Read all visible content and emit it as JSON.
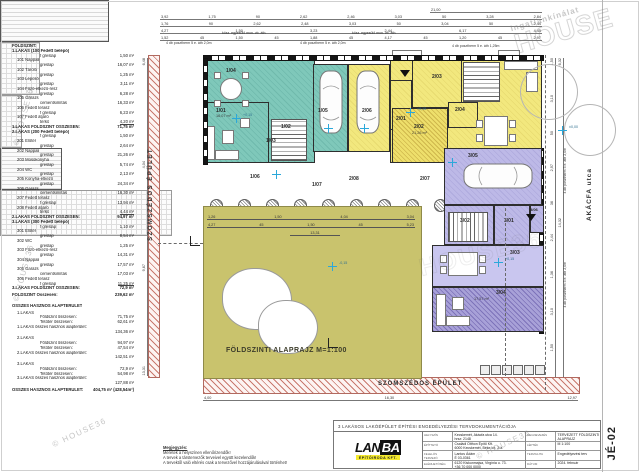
{
  "watermark": {
    "copyright": "© HOUSE36",
    "brand_top": "Ingatlankínálat",
    "brand_big": "HOUSE",
    "brand_big2": "HOUSE36"
  },
  "schedule": {
    "lines": [
      {
        "t": "FÖLDSZINT:",
        "c": "h"
      },
      {
        "t": "1.LAKÁS (100 Fedett belépő)",
        "c": "h"
      },
      {
        "t": "f greslap",
        "v": "1,50 m²",
        "c": "i2"
      },
      {
        "t": "101 Nappali",
        "c": "i1"
      },
      {
        "t": "greslap",
        "v": "16,07 m²",
        "c": "i2"
      },
      {
        "t": "102 Tároló",
        "c": "i1"
      },
      {
        "t": "greslap",
        "v": "1,25 m²",
        "c": "i2"
      },
      {
        "t": "103 Lépcső",
        "c": "i1"
      },
      {
        "t": "greslap",
        "v": "3,11 m²",
        "c": "i2"
      },
      {
        "t": "104 Főző-étkező-rész",
        "c": "i1"
      },
      {
        "t": "greslap",
        "v": "6,28 m²",
        "c": "i2"
      },
      {
        "t": "105 Garázs",
        "c": "i1"
      },
      {
        "t": "cementsimítás",
        "v": "16,33 m²",
        "c": "i2"
      },
      {
        "t": "106 Fedett terasz",
        "c": "i1"
      },
      {
        "t": "f greslap",
        "v": "6,23 m²",
        "c": "i2"
      },
      {
        "t": "107 Fedett átjáró",
        "c": "i1"
      },
      {
        "t": "térkő",
        "v": "4,20 m²",
        "c": "i2 u"
      },
      {
        "t": "1.LAKÁS FÖLDSZINT ÖSSZESEN:",
        "v": "71,75 m²",
        "c": "h"
      },
      {
        "t": "2.LAKÁS (200 Fedett belépő)",
        "c": "h"
      },
      {
        "t": "f greslap",
        "v": "1,50 m²",
        "c": "i2"
      },
      {
        "t": "201 Előtér",
        "c": "i1"
      },
      {
        "t": "greslap",
        "v": "2,64 m²",
        "c": "i2"
      },
      {
        "t": "202 Nappali",
        "c": "i1"
      },
      {
        "t": "greslap",
        "v": "21,26 m²",
        "c": "i2"
      },
      {
        "t": "203 Mosókonyha",
        "c": "i1"
      },
      {
        "t": "greslap",
        "v": "5,74 m²",
        "c": "i2"
      },
      {
        "t": "204 WC",
        "c": "i1"
      },
      {
        "t": "greslap",
        "v": "2,13 m²",
        "c": "i2"
      },
      {
        "t": "205 Konyha-étkező",
        "c": "i1"
      },
      {
        "t": "greslap",
        "v": "24,34 m²",
        "c": "i2"
      },
      {
        "t": "206 Garázs",
        "c": "i1"
      },
      {
        "t": "cementsimítás",
        "v": "16,30 m²",
        "c": "i2"
      },
      {
        "t": "207 Fedett terasz",
        "c": "i1"
      },
      {
        "t": "f greslap",
        "v": "13,94 m²",
        "c": "i2"
      },
      {
        "t": "208 Fedett átjáró",
        "c": "i1"
      },
      {
        "t": "térkő",
        "v": "4,44 m²",
        "c": "i2 u"
      },
      {
        "t": "2.LAKÁS FÖLDSZINT ÖSSZESEN:",
        "v": "94,97 m²",
        "c": "h"
      },
      {
        "t": "3.LAKÁS (300 Fedett belépő)",
        "c": "h"
      },
      {
        "t": "f greslap",
        "v": "1,10 m²",
        "c": "i2"
      },
      {
        "t": "301 Előtér",
        "c": "i1"
      },
      {
        "t": "greslap",
        "v": "8,54 m²",
        "c": "i2"
      },
      {
        "t": "302 WC",
        "c": "i1"
      },
      {
        "t": "greslap",
        "v": "1,25 m²",
        "c": "i2"
      },
      {
        "t": "303 Főző-étkező-rész",
        "c": "i1"
      },
      {
        "t": "greslap",
        "v": "14,31 m²",
        "c": "i2"
      },
      {
        "t": "304 Nappali",
        "c": "i1"
      },
      {
        "t": "greslap",
        "v": "17,57 m²",
        "c": "i2"
      },
      {
        "t": "305 Garázs",
        "c": "i1"
      },
      {
        "t": "cementsimítás",
        "v": "17,03 m²",
        "c": "i2"
      },
      {
        "t": "306 Fedett terasz",
        "c": "i1"
      },
      {
        "t": "f greslap",
        "v": "11,25 m²",
        "c": "i2 u"
      },
      {
        "t": "3.LAKÁS FÖLDSZINT ÖSSZESEN:",
        "v": "72,9 m²",
        "c": "h"
      },
      {
        "t": "FÖLDSZINT Összesen:",
        "v": "239,62 m²",
        "c": "h gap"
      },
      {
        "t": "",
        "c": "sp"
      },
      {
        "t": "ÖSSZES HASZNOS ALAPTERÜLET",
        "c": "h"
      },
      {
        "t": "1.LAKÁS",
        "c": "i1 gap"
      },
      {
        "t": "Földszint összesen:",
        "v": "71,75 m²",
        "c": "i2"
      },
      {
        "t": "Tetőtér összesen:",
        "v": "62,61 m²",
        "c": "i2"
      },
      {
        "t": "1.LAKÁS összes hasznos alapterület:",
        "c": "i1"
      },
      {
        "t": "",
        "v": "134,36 m²",
        "c": "i2"
      },
      {
        "t": "2.LAKÁS",
        "c": "i1 gap"
      },
      {
        "t": "Földszint összesen:",
        "v": "94,97 m²",
        "c": "i2"
      },
      {
        "t": "Tetőtér összesen:",
        "v": "47,54 m²",
        "c": "i2"
      },
      {
        "t": "2.LAKÁS összes hasznos alapterület:",
        "c": "i1"
      },
      {
        "t": "",
        "v": "142,51 m²",
        "c": "i2"
      },
      {
        "t": "3.LAKÁS",
        "c": "i1 gap"
      },
      {
        "t": "Földszint összesen:",
        "v": "72,9 m²",
        "c": "i2"
      },
      {
        "t": "Tetőtér összesen:",
        "v": "54,98 m²",
        "c": "i2"
      },
      {
        "t": "3.LAKÁS összes hasznos alapterület:",
        "c": "i1"
      },
      {
        "t": "",
        "v": "127,88 m²",
        "c": "i2"
      },
      {
        "t": "ÖSSZES HASZNOS ALAPTERÜLET:",
        "v": "404,75 m² (428,54m²)",
        "c": "h gap"
      }
    ]
  },
  "plan": {
    "title": "FÖLDSZINTI ALAPRAJZ M=1:100",
    "neighbor_left": "SZOMSZÉDOS ÉPÜLET",
    "neighbor_bottom": "SZOMSZÉDOS ÉPÜLET",
    "street": "AKÁCFA utca",
    "rooms": {
      "r101": "1/01",
      "r102": "1/02",
      "r103": "1/03",
      "r104": "1/04",
      "r105": "1/05",
      "r106": "1/06",
      "r107": "1/07",
      "r201": "2/01",
      "r202": "2/02",
      "r203": "2/03",
      "r204": "2/04",
      "r205": "2/05",
      "r206": "2/06",
      "r207": "2/07",
      "r208": "2/08",
      "r301": "3/01",
      "r302": "3/02",
      "r303": "3/03",
      "r304": "3/04",
      "r305": "3/05",
      "r306": "3/06"
    },
    "areas": {
      "a101": "16,07 m²",
      "a202": "21,26 m²",
      "a304": "17,57 m²"
    },
    "levels": {
      "plus15": "+0,15",
      "zero": "±0,00",
      "minus15": "-0,15"
    },
    "ann": {
      "posztherm": "4 db posztherm 5 e. áth 2,0m",
      "posztherm2": "4 db posztherm 5 e. áth 1,25m",
      "koszoru": "kösz. egyesülő mon. vb. áth."
    },
    "dims": {
      "overall": [
        "21,00"
      ],
      "top1": [
        "3,92",
        "1,75",
        "90",
        "2,62",
        "2,46",
        "3,03",
        "50",
        "3,28",
        "2,84"
      ],
      "top2": [
        "1,76",
        "90",
        "2,62",
        "2,48",
        "3,03",
        "50",
        "3,04",
        "50",
        "2,44"
      ],
      "top3": [
        "4,27",
        "1,50",
        "3,23",
        "2,44",
        "6,17",
        "4,45"
      ],
      "top4": [
        "1,52",
        "45",
        "1,50",
        "45",
        "1,88",
        "45",
        "4,17",
        "45",
        "1,20",
        "45",
        "2,97"
      ],
      "right1": [
        "1,50",
        "3,10",
        "50",
        "2,97",
        "36",
        "2,44",
        "1,36",
        "3,10",
        "1,50",
        "4,17"
      ],
      "right2": [
        "6,32",
        "14,32",
        "9,67"
      ],
      "left1": [
        "6,48",
        "4,04",
        "9,67",
        "13,31"
      ],
      "g1": [
        "1,26",
        "1,50",
        "4,04",
        "3,04"
      ],
      "g2": [
        "4,27",
        "45",
        "1,50",
        "45",
        "5,23"
      ],
      "g3": [
        "13,31"
      ],
      "bottom1": [
        "4,00",
        "16,30",
        "12,97"
      ]
    }
  },
  "notes": {
    "heading": "Megjegyzés:",
    "lines": [
      "Méretek a helyszínen ellenőrizendők!",
      "A tervek a társtervezők terveivel együtt kezelendők!",
      "A tervektől való eltérés csak a tervezővel hozzájárulásával történhet!"
    ]
  },
  "titleblock": {
    "project": "3 LAKÁSOS LAKÓÉPÜLET ÉPÍTÉSI ENGEDÉLYEZÉSI TERVDOKUMENTÁCIÓJA",
    "logo": {
      "main": "LAN",
      "box": "BA",
      "sub": "ÉPÍTŐIRODA KFT."
    },
    "rows": [
      {
        "label": "HELYSZÍN",
        "v1": "Kecskemét, Akácfa utca 14.",
        "v2": "hrsz: 2148"
      },
      {
        "label": "ÉPÍTTETŐ",
        "v1": "Családi Otthon Építő Kft.",
        "v2": "6000 Kecskemét, Béke krt. 2/a."
      },
      {
        "label": "FELELŐS TERVEZŐ",
        "v1": "Lantos Ádám",
        "v2": "É 03-0361"
      },
      {
        "label": "ELÉRHETŐSÉG",
        "v1": "6120 Kiskunmajsa, Virgínia u. 73.",
        "v2": "+36 70 000 0000"
      }
    ],
    "rows_right": [
      {
        "label": "MEGNEVEZÉS",
        "v1": "TERVEZETT FÖLDSZINTI",
        "v2": "ALAPRAJZ"
      },
      {
        "label": "LÉPTÉK",
        "v1": "M 1:100",
        "v2": ""
      },
      {
        "label": "TERVFAJTA",
        "v1": "Engedélyezési terv",
        "v2": ""
      },
      {
        "label": "DÁTUM",
        "v1": "2024. február",
        "v2": ""
      }
    ],
    "sheet": "JÉ-02"
  }
}
